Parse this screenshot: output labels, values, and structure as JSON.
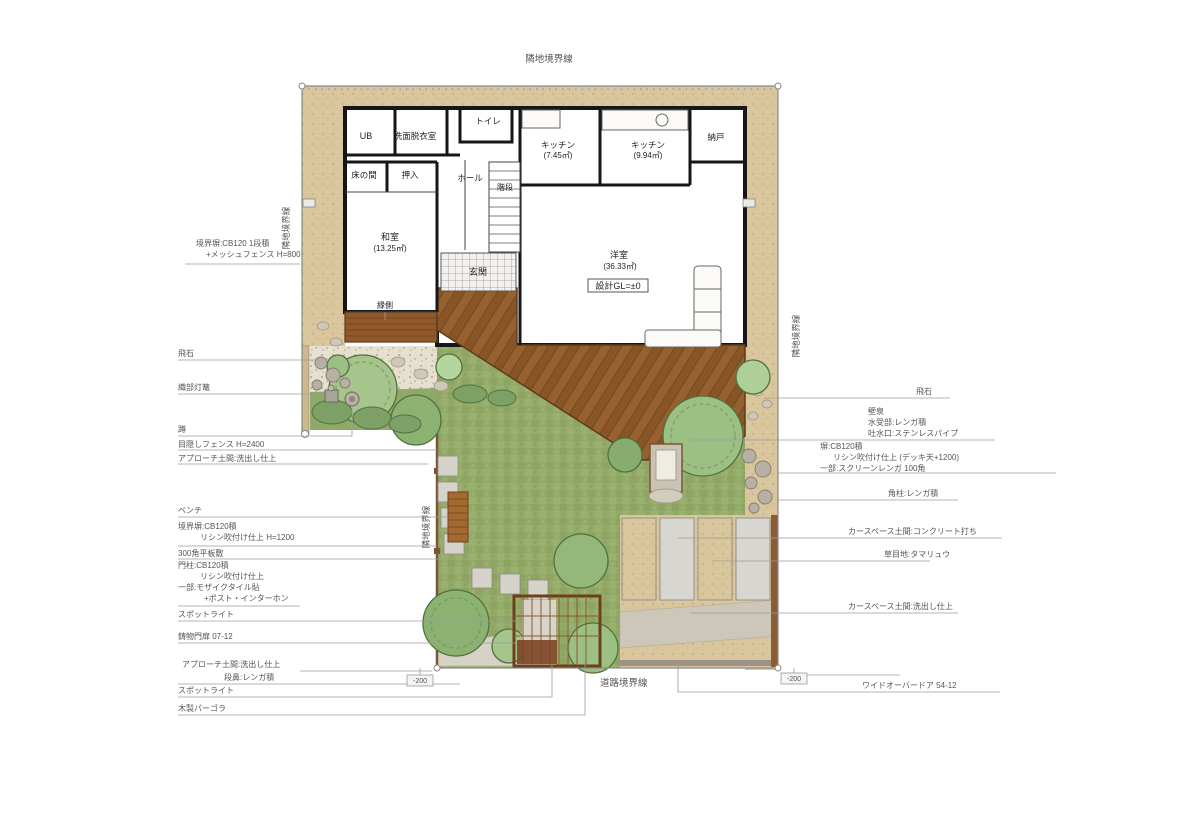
{
  "boundary": {
    "top": "隣地境界線",
    "left": "隣地境界線",
    "middle": "隣地境界線",
    "right": "隣地境界線",
    "road": "道路境界線"
  },
  "rooms": {
    "ub": "UB",
    "laundry": "洗面脱衣室",
    "toilet": "トイレ",
    "kitchen_a": "キッチン",
    "kitchen_a_area": "(7.45㎡)",
    "kitchen_b": "キッチン",
    "kitchen_b_area": "(9.94㎡)",
    "storeroom": "納戸",
    "tokonoma": "床の間",
    "closet": "押入",
    "hall": "ホール",
    "stairs": "階段",
    "tatami": "和室",
    "tatami_area": "(13.25㎡)",
    "entrance": "玄関",
    "veranda": "縁側",
    "living": "洋室",
    "living_area": "(36.33㎡)",
    "design_gl": "設計GL=±0"
  },
  "left_annotations": {
    "wall_top_1": "境界塀:CB120 1段積",
    "wall_top_2": "+メッシュフェンス H=800",
    "tobiishi": "飛石",
    "lantern": "織部灯篭",
    "tsukubai": "蹲",
    "fence": "目隠しフェンス H=2400",
    "approach_top": "アプローチ土間:洗出し仕上",
    "bench": "ベンチ",
    "wall_mid_1": "境界塀:CB120積",
    "wall_mid_2": "リシン吹付け仕上 H=1200",
    "plates": "300角平板敷",
    "gatepost_1": "門柱:CB120積",
    "gatepost_2": "リシン吹付け仕上",
    "gatepost_3": "一部:モザイクタイル貼",
    "gatepost_4": "+ポスト・インターホン",
    "spotlight_1": "スポットライト",
    "gate": "鋳物門扉 07-12",
    "approach_bottom_1": "アプローチ土間:洗出し仕上",
    "approach_bottom_2": "段鼻:レンガ積",
    "spotlight_2": "スポットライト",
    "pergola": "木製パーゴラ"
  },
  "right_annotations": {
    "tobiishi": "飛石",
    "fountain_1": "壁泉",
    "fountain_2": "水受部:レンガ積",
    "fountain_3": "吐水口:ステンレスパイプ",
    "wall_1": "塀:CB120積",
    "wall_2": "リシン吹付け仕上 (デッキ天+1200)",
    "wall_3": "一部:スクリーンレンガ 100角",
    "post": "角柱:レンガ積",
    "carspace_concrete": "カースペース土間:コンクリート打ち",
    "joint": "草目地:タマリュウ",
    "carspace_washout": "カースペース土間:洗出し仕上",
    "overdoor": "ワイドオーバードア 54-12"
  },
  "levels": {
    "left": "-200",
    "right": "-200"
  }
}
